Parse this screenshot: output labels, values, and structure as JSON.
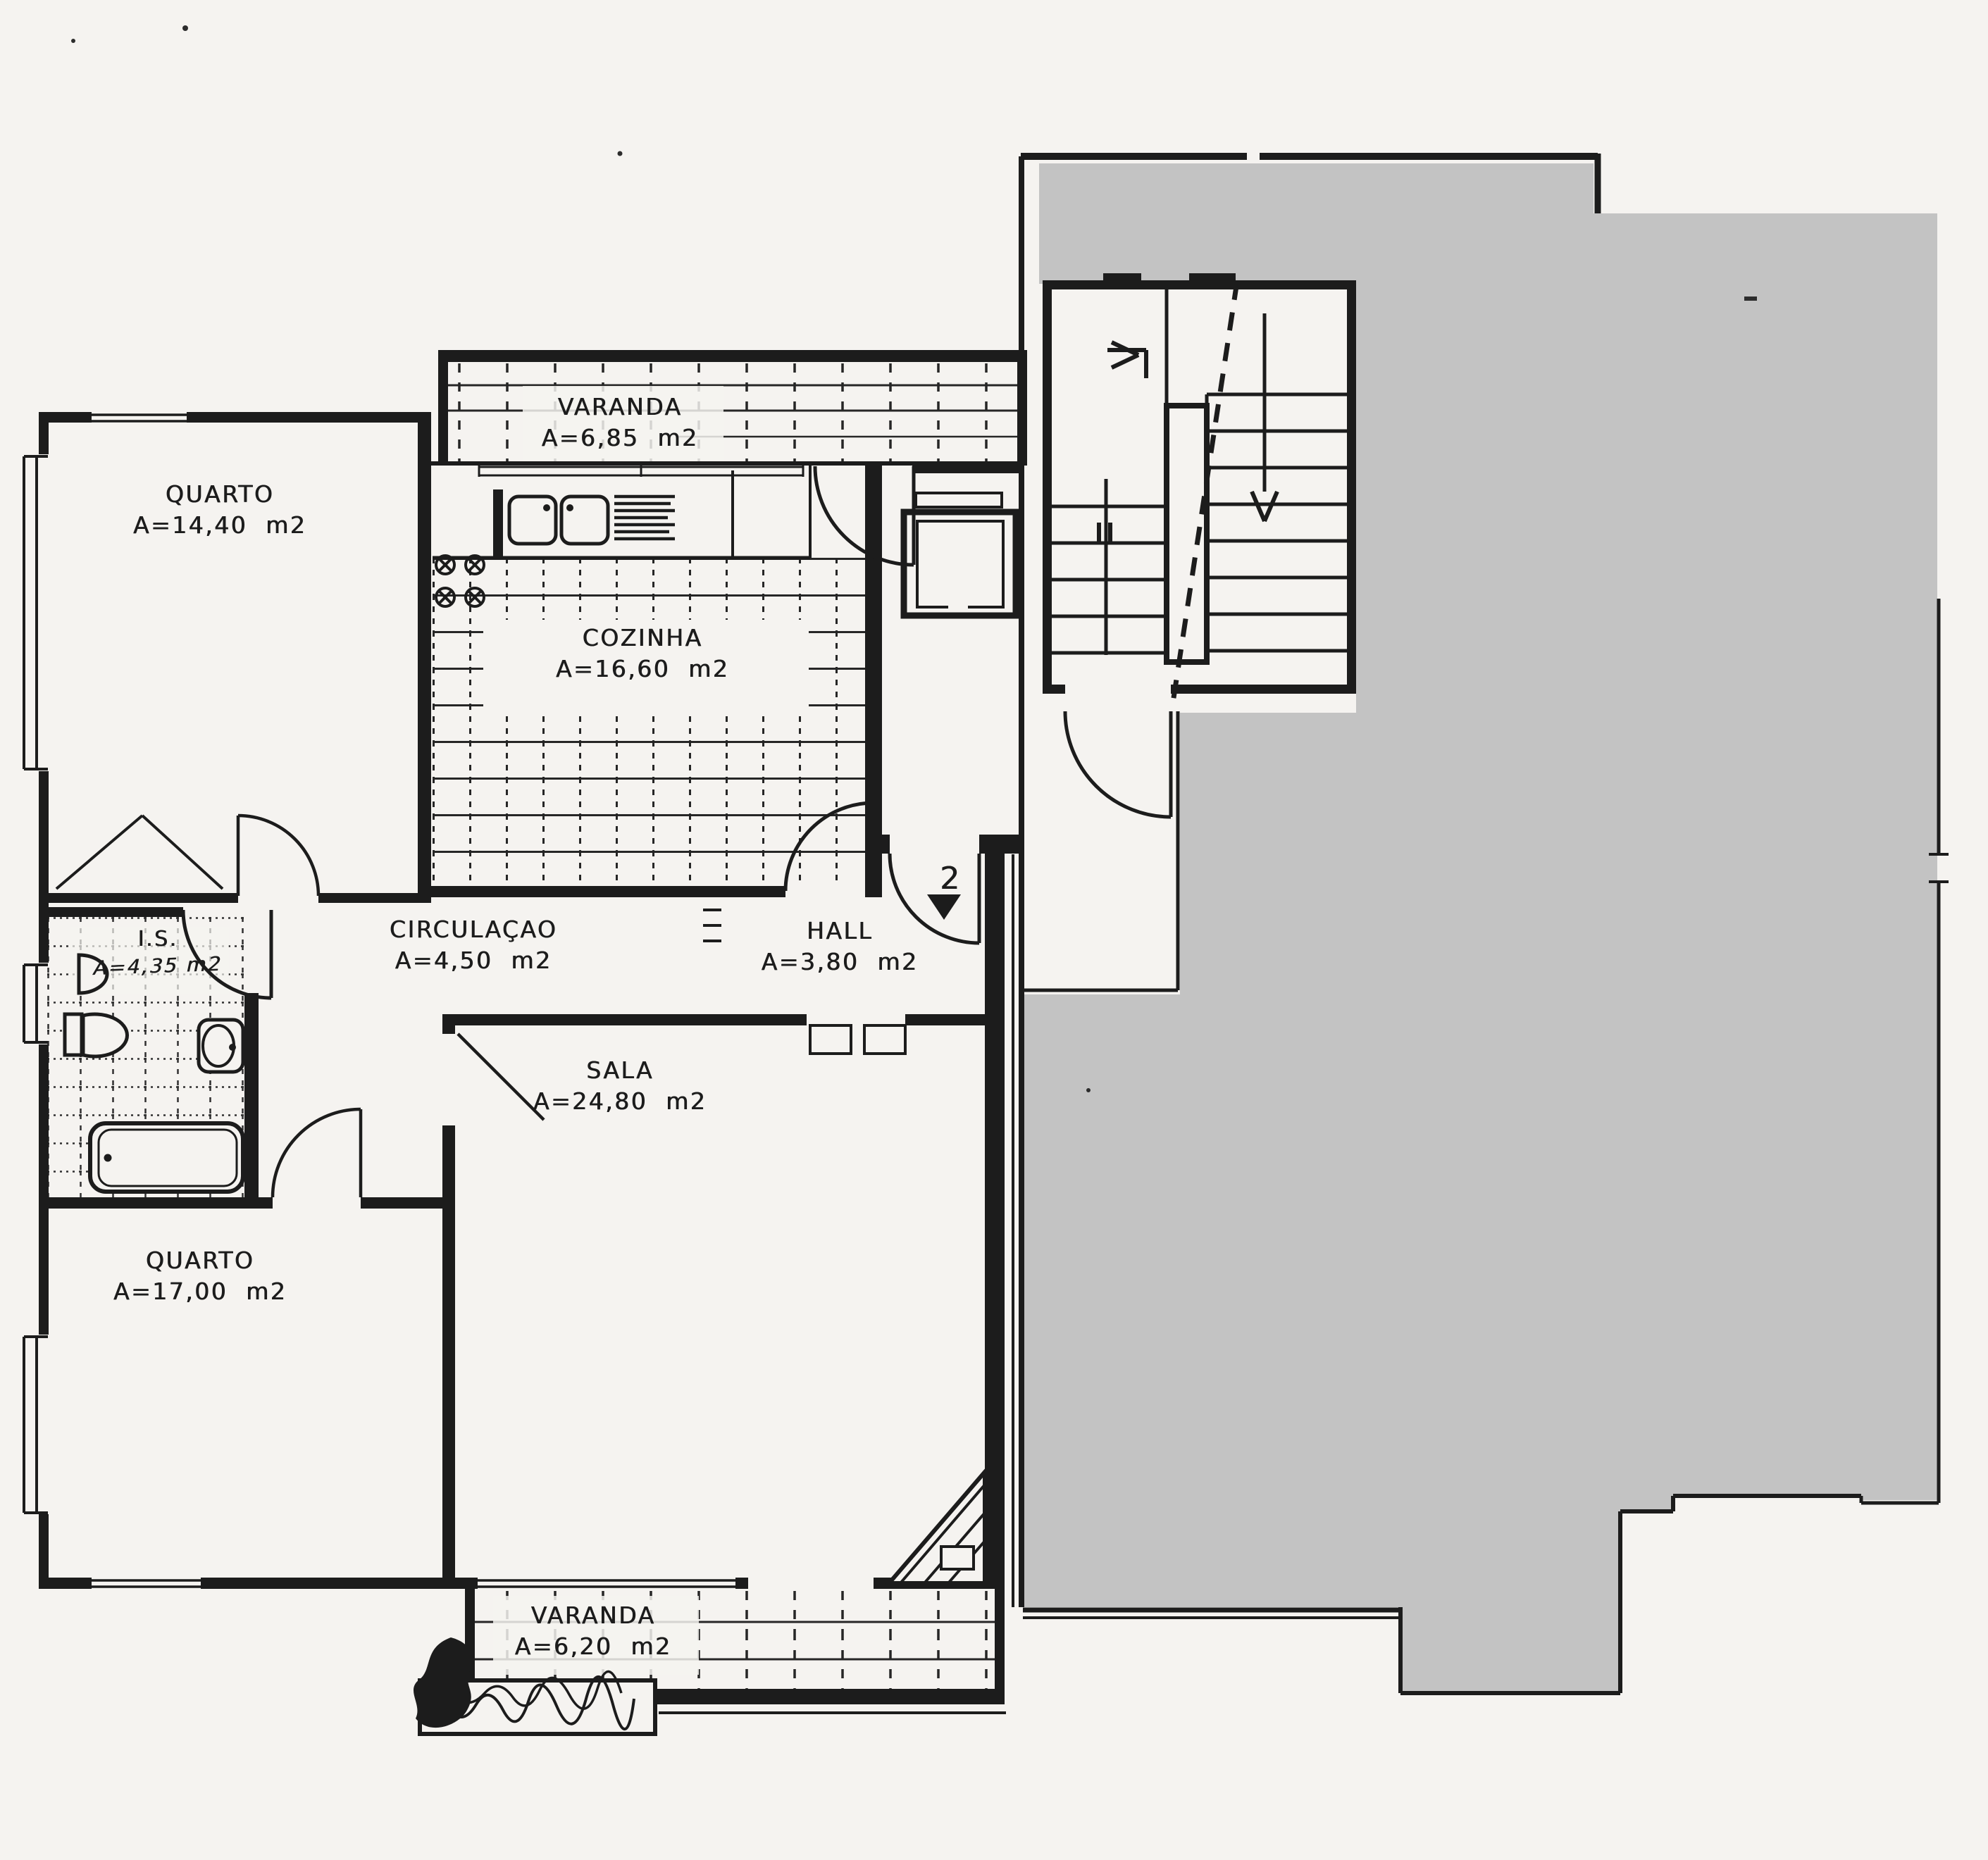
{
  "plan": {
    "language": "pt",
    "rooms": {
      "varanda_top": {
        "name": "VARANDA",
        "area": "A=6,85  m2"
      },
      "quarto_1": {
        "name": "QUARTO",
        "area": "A=14,40  m2"
      },
      "cozinha": {
        "name": "COZINHA",
        "area": "A=16,60  m2"
      },
      "circulacao": {
        "name": "CIRCULAÇAO",
        "area": "A=4,50  m2"
      },
      "hall": {
        "name": "HALL",
        "area": "A=3,80  m2"
      },
      "is": {
        "name": "I.S.",
        "area": "A=4,35 m2"
      },
      "sala": {
        "name": "SALA",
        "area": "A=24,80  m2"
      },
      "quarto_2": {
        "name": "QUARTO",
        "area": "A=17,00  m2"
      },
      "varanda_bottom": {
        "name": "VARANDA",
        "area": "A=6,20  m2"
      }
    },
    "annotations": {
      "apartment_number": "2"
    },
    "colors": {
      "paper": "#f5f3f0",
      "ink": "#1c1c1c",
      "redaction_gray": "#c3c3c3"
    }
  }
}
